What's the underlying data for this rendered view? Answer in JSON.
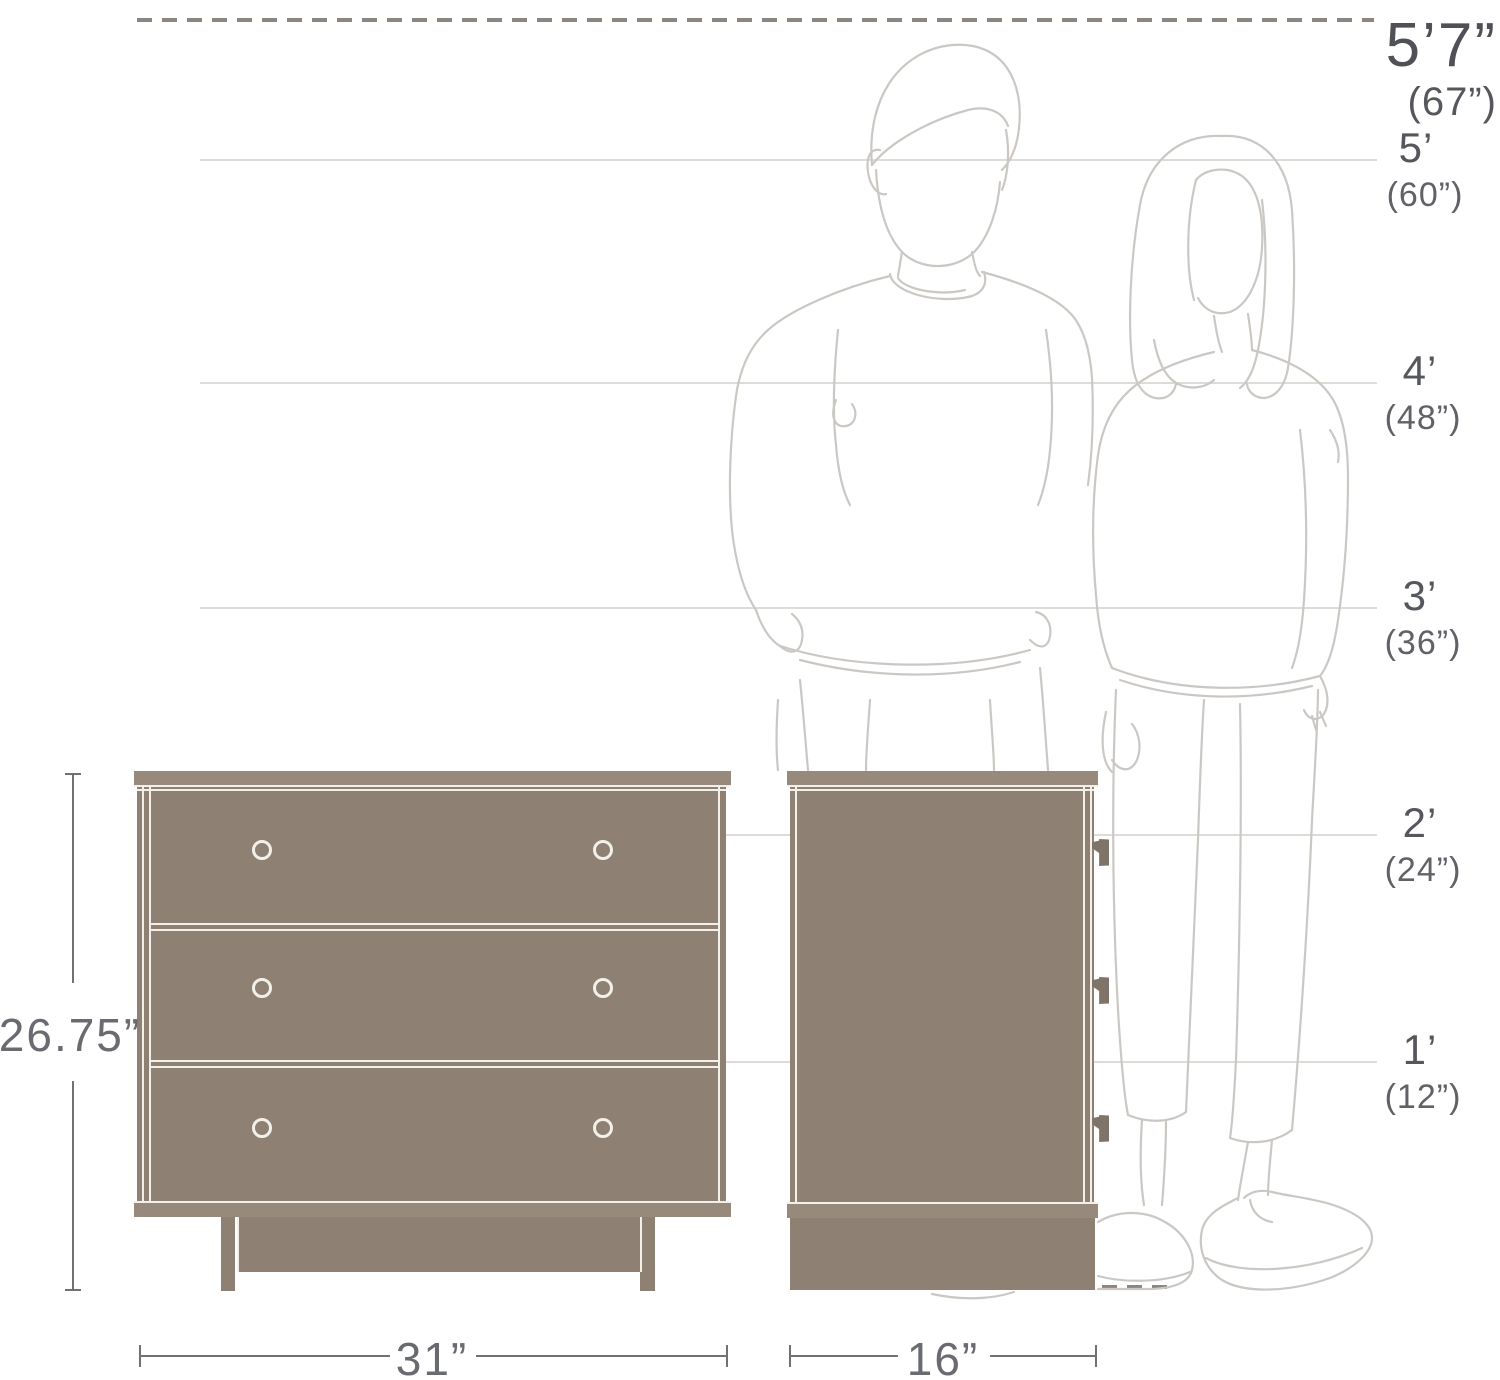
{
  "scale": {
    "dashed_marker": {
      "feet": "5’7”",
      "inches": "(67”)"
    },
    "markers": [
      {
        "feet": "5’",
        "inches": "(60”)"
      },
      {
        "feet": "4’",
        "inches": "(48”)"
      },
      {
        "feet": "3’",
        "inches": "(36”)"
      },
      {
        "feet": "2’",
        "inches": "(24”)"
      },
      {
        "feet": "1’",
        "inches": "(12”)"
      }
    ]
  },
  "dimensions": {
    "height": "26.75”",
    "width": "31”",
    "depth": "16”"
  },
  "colors": {
    "dresser_fill": "#8e8174",
    "dresser_board": "#97897c",
    "outline_white": "#f3f0ea",
    "figure_line": "#cbc8c4",
    "gridline": "#dedcd9",
    "dash_line": "#8b8680",
    "label_text": "#55575c",
    "dimension_text": "#696b70"
  },
  "figures": {
    "left": "man-outline",
    "right": "woman-outline"
  }
}
